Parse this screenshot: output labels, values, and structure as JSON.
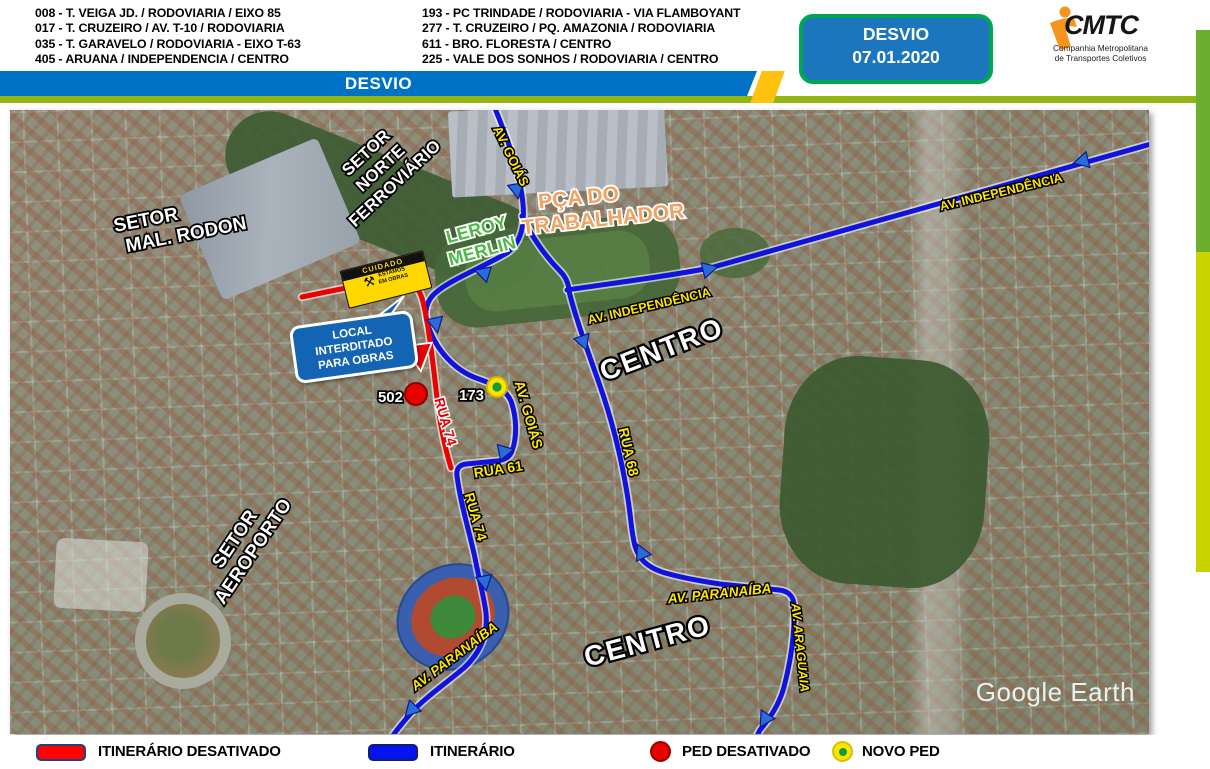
{
  "header": {
    "routes_left": [
      "008 - T. VEIGA JD. / RODOVIARIA / EIXO 85",
      "017 - T. CRUZEIRO / AV. T-10 / RODOVIARIA",
      "035 - T. GARAVELO / RODOVIARIA - EIXO T-63",
      "405 - ARUANA / INDEPENDENCIA / CENTRO"
    ],
    "routes_right": [
      "193 - PC TRINDADE / RODOVIARIA - VIA FLAMBOYANT",
      "277 - T. CRUZEIRO / PQ. AMAZONIA / RODOVIARIA",
      "611 - BRO. FLORESTA / CENTRO",
      "225 - VALE DOS SONHOS / RODOVIARIA / CENTRO"
    ],
    "banner_title": "DESVIO",
    "badge": {
      "title": "DESVIO",
      "date": "07.01.2020"
    },
    "logo": {
      "acronym": "CMTC",
      "subtitle_line1": "Companhia Metropolitana",
      "subtitle_line2": "de Transportes Coletivos"
    }
  },
  "map": {
    "watermark": "Google Earth",
    "labels": {
      "setor_rodon_line1": "SETOR",
      "setor_rodon_line2": "MAL. RODON",
      "setor_norte_line1": "SETOR",
      "setor_norte_line2": "NORTE",
      "setor_norte_line3": "FERROVIÁRIO",
      "leroy_line1": "LEROY",
      "leroy_line2": "MERLIN",
      "praca_line1": "PÇA DO",
      "praca_line2": "TRABALHADOR",
      "av_goias_top": "AV. GOIÁS",
      "av_goias_mid": "AV. GOIÁS",
      "av_independencia_topright": "AV. INDEPENDÊNCIA",
      "av_independencia_center": "AV. INDEPENDÊNCIA",
      "centro_north": "CENTRO",
      "centro_south": "CENTRO",
      "setor_aeroporto_line1": "SETOR",
      "setor_aeroporto_line2": "AEROPORTO",
      "rua_61": "RUA 61",
      "rua_68": "RUA 68",
      "rua_74_active": "RUA 74",
      "rua_74_deactivated": "RUA 74",
      "av_paranaiba_west": "AV. PARANAÍBA",
      "av_paranaiba_east": "AV. PARANAÍBA",
      "av_araguaia": "AV. ARAGUAIA",
      "stop_deactivated": "502",
      "stop_new": "173"
    },
    "callouts": {
      "closed_line1": "LOCAL INTERDITADO",
      "closed_line2": "PARA OBRAS",
      "caution_title": "CUIDADO",
      "caution_line1": "ESTAMOS",
      "caution_line2": "EM OBRAS"
    }
  },
  "legend": {
    "deactivated_route": "ITINERÁRIO DESATIVADO",
    "route": "ITINERÁRIO",
    "deactivated_stop": "PED DESATIVADO",
    "new_stop": "NOVO PED"
  },
  "colors": {
    "route_active": "#1013dd",
    "route_deactivated": "#ea0202",
    "street_label_yellow": "#ffe600",
    "header_bar_blue": "#0072c6",
    "header_bar_green": "#93b513",
    "accent_yellow_stripe": "#ffc20e",
    "badge_fill": "#1b76bd",
    "badge_border": "#00a650",
    "side_bar_green": "#6cae2e",
    "side_bar_lime": "#c9d300",
    "logo_orange": "#f7941d",
    "new_stop_green": "#119e38",
    "leroy_green": "#4db848",
    "praca_orange": "#f2a263"
  }
}
